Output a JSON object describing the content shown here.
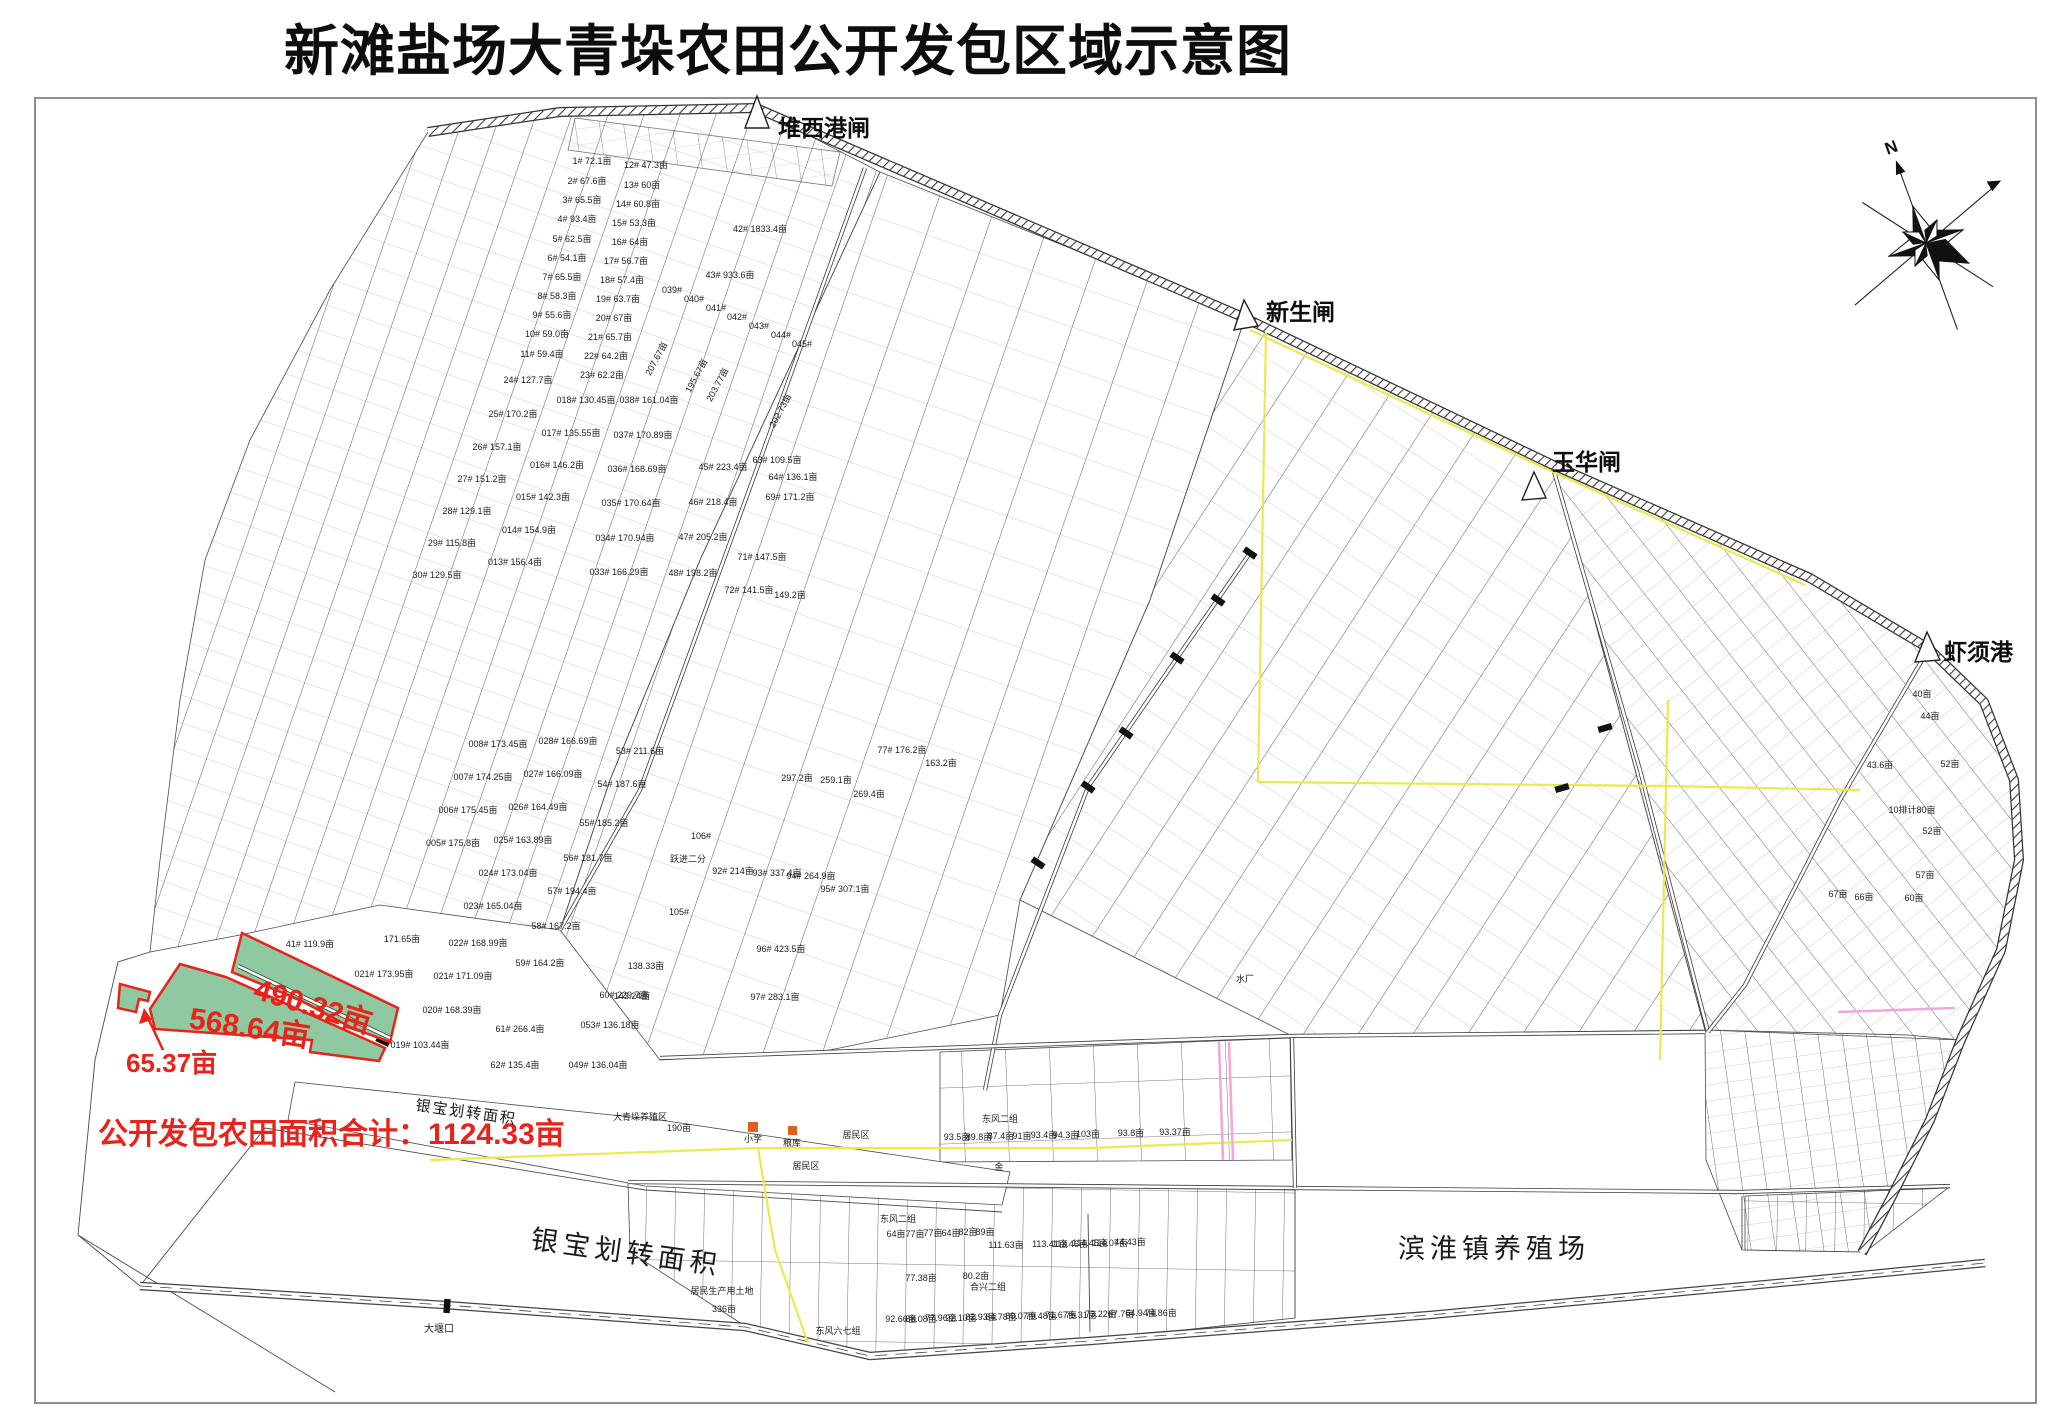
{
  "title": "新滩盐场大青垛农田公开发包区域示意图",
  "colors": {
    "highlight_green": "#8fc9a2",
    "annotation_red": "#e8231a",
    "zone_yellow": "#ece94f",
    "road_pink": "#f0a8da",
    "building_orange": "#e0611f"
  },
  "map": {
    "compass": {
      "label": "N"
    },
    "gates": [
      {
        "label": "堆西港闸"
      },
      {
        "label": "新生闸"
      },
      {
        "label": "玉华闸"
      },
      {
        "label": "虾须港"
      }
    ],
    "highlights": {
      "parcel_490": {
        "label": "490.32亩"
      },
      "parcel_568": {
        "label": "568.64亩"
      },
      "parcel_65": {
        "label": "65.37亩"
      },
      "total": "公开发包农田面积合计：1124.33亩"
    },
    "regions": {
      "yinbao_small": "银宝划转面积",
      "yinbao_large": "银宝划转面积",
      "binhuai": "滨淮镇养殖场",
      "dayankou": "大堰口"
    },
    "parcels": [
      {
        "t": "1# 72.1亩",
        "x": 592,
        "y": 164
      },
      {
        "t": "2# 67.6亩",
        "x": 587,
        "y": 184
      },
      {
        "t": "3# 65.5亩",
        "x": 582,
        "y": 203
      },
      {
        "t": "4# 93.4亩",
        "x": 577,
        "y": 222
      },
      {
        "t": "5# 62.5亩",
        "x": 572,
        "y": 242
      },
      {
        "t": "6# 54.1亩",
        "x": 567,
        "y": 261
      },
      {
        "t": "7# 65.5亩",
        "x": 562,
        "y": 280
      },
      {
        "t": "8# 58.3亩",
        "x": 557,
        "y": 299
      },
      {
        "t": "9# 55.6亩",
        "x": 552,
        "y": 318
      },
      {
        "t": "10# 59.0亩",
        "x": 547,
        "y": 337
      },
      {
        "t": "11# 59.4亩",
        "x": 542,
        "y": 357
      },
      {
        "t": "24# 127.7亩",
        "x": 528,
        "y": 383
      },
      {
        "t": "25# 170.2亩",
        "x": 513,
        "y": 417
      },
      {
        "t": "26# 157.1亩",
        "x": 497,
        "y": 450
      },
      {
        "t": "27# 151.2亩",
        "x": 482,
        "y": 482
      },
      {
        "t": "28# 129.1亩",
        "x": 467,
        "y": 514
      },
      {
        "t": "29# 115.8亩",
        "x": 452,
        "y": 546
      },
      {
        "t": "30# 129.5亩",
        "x": 437,
        "y": 578
      },
      {
        "t": "12# 47.3亩",
        "x": 646,
        "y": 168
      },
      {
        "t": "13# 60亩",
        "x": 642,
        "y": 188
      },
      {
        "t": "14# 60.8亩",
        "x": 638,
        "y": 207
      },
      {
        "t": "15# 53.3亩",
        "x": 634,
        "y": 226
      },
      {
        "t": "16# 64亩",
        "x": 630,
        "y": 245
      },
      {
        "t": "17# 56.7亩",
        "x": 626,
        "y": 264
      },
      {
        "t": "18# 57.4亩",
        "x": 622,
        "y": 283
      },
      {
        "t": "19# 63.7亩",
        "x": 618,
        "y": 302
      },
      {
        "t": "20# 67亩",
        "x": 614,
        "y": 321
      },
      {
        "t": "21# 65.7亩",
        "x": 610,
        "y": 340
      },
      {
        "t": "22# 64.2亩",
        "x": 606,
        "y": 359
      },
      {
        "t": "23# 62.2亩",
        "x": 602,
        "y": 378
      },
      {
        "t": "42#  1833.4亩",
        "x": 760,
        "y": 232,
        "s": 10
      },
      {
        "t": "43#  933.6亩",
        "x": 730,
        "y": 278,
        "s": 10
      },
      {
        "t": "018# 130.45亩",
        "x": 586,
        "y": 403
      },
      {
        "t": "017# 135.55亩",
        "x": 571,
        "y": 436
      },
      {
        "t": "016# 146.2亩",
        "x": 557,
        "y": 468
      },
      {
        "t": "015# 142.3亩",
        "x": 543,
        "y": 500
      },
      {
        "t": "014# 154.9亩",
        "x": 529,
        "y": 533
      },
      {
        "t": "013# 156.4亩",
        "x": 515,
        "y": 565
      },
      {
        "t": "038# 161.04亩",
        "x": 649,
        "y": 403
      },
      {
        "t": "037# 170.89亩",
        "x": 643,
        "y": 438
      },
      {
        "t": "036# 168.69亩",
        "x": 637,
        "y": 472
      },
      {
        "t": "035# 170.64亩",
        "x": 631,
        "y": 506
      },
      {
        "t": "034# 170.94亩",
        "x": 625,
        "y": 541
      },
      {
        "t": "033# 166.29亩",
        "x": 619,
        "y": 575
      },
      {
        "t": "028# 166.69亩",
        "x": 568,
        "y": 744
      },
      {
        "t": "027# 166.09亩",
        "x": 553,
        "y": 777
      },
      {
        "t": "026# 164.49亩",
        "x": 538,
        "y": 810
      },
      {
        "t": "025# 163.89亩",
        "x": 523,
        "y": 843
      },
      {
        "t": "024# 173.04亩",
        "x": 508,
        "y": 876
      },
      {
        "t": "023# 165.04亩",
        "x": 493,
        "y": 909
      },
      {
        "t": "022# 168.99亩",
        "x": 478,
        "y": 946
      },
      {
        "t": "021# 171.09亩",
        "x": 463,
        "y": 979
      },
      {
        "t": "020# 168.39亩",
        "x": 452,
        "y": 1013
      },
      {
        "t": "008# 173.45亩",
        "x": 498,
        "y": 747
      },
      {
        "t": "007# 174.25亩",
        "x": 483,
        "y": 780
      },
      {
        "t": "006# 175.45亩",
        "x": 468,
        "y": 813
      },
      {
        "t": "005# 175.8亩",
        "x": 453,
        "y": 846
      },
      {
        "t": "53# 211.6亩",
        "x": 640,
        "y": 754
      },
      {
        "t": "54# 187.6亩",
        "x": 622,
        "y": 787
      },
      {
        "t": "55# 185.2亩",
        "x": 604,
        "y": 826
      },
      {
        "t": "56# 181.7亩",
        "x": 588,
        "y": 861
      },
      {
        "t": "57# 194.4亩",
        "x": 572,
        "y": 894
      },
      {
        "t": "58# 167.2亩",
        "x": 556,
        "y": 929
      },
      {
        "t": "59# 164.2亩",
        "x": 540,
        "y": 966
      },
      {
        "t": "60# 229.7亩",
        "x": 624,
        "y": 998
      },
      {
        "t": "41# 119.9亩",
        "x": 310,
        "y": 947
      },
      {
        "t": "171.65亩",
        "x": 402,
        "y": 942
      },
      {
        "t": "021# 173.95亩",
        "x": 384,
        "y": 977
      },
      {
        "t": "019# 103.44亩",
        "x": 420,
        "y": 1048
      },
      {
        "t": "61# 266.4亩",
        "x": 520,
        "y": 1032
      },
      {
        "t": "62# 135.4亩",
        "x": 515,
        "y": 1068
      },
      {
        "t": "053# 136.18亩",
        "x": 610,
        "y": 1028
      },
      {
        "t": "049# 136.04亩",
        "x": 598,
        "y": 1068
      },
      {
        "t": "297.2亩",
        "x": 797,
        "y": 781
      },
      {
        "t": "259.1亩",
        "x": 836,
        "y": 783
      },
      {
        "t": "269.4亩",
        "x": 869,
        "y": 797
      },
      {
        "t": "92# 214亩",
        "x": 733,
        "y": 874
      },
      {
        "t": "93# 337.4亩",
        "x": 777,
        "y": 876
      },
      {
        "t": "94# 264.9亩",
        "x": 811,
        "y": 879
      },
      {
        "t": "95# 307.1亩",
        "x": 845,
        "y": 892
      },
      {
        "t": "96# 423.5亩",
        "x": 781,
        "y": 952
      },
      {
        "t": "97# 283.1亩",
        "x": 775,
        "y": 1000
      },
      {
        "t": "77# 176.2亩",
        "x": 902,
        "y": 753
      },
      {
        "t": "163.2亩",
        "x": 941,
        "y": 766
      },
      {
        "t": "106#",
        "x": 701,
        "y": 839
      },
      {
        "t": "跃进二分",
        "x": 688,
        "y": 862,
        "s": 8
      },
      {
        "t": "105#",
        "x": 679,
        "y": 915
      },
      {
        "t": "143.24亩",
        "x": 632,
        "y": 999
      },
      {
        "t": "138.33亩",
        "x": 646,
        "y": 969
      },
      {
        "t": "039#",
        "x": 672,
        "y": 293
      },
      {
        "t": "040#",
        "x": 694,
        "y": 302
      },
      {
        "t": "041#",
        "x": 716,
        "y": 311
      },
      {
        "t": "042#",
        "x": 737,
        "y": 320
      },
      {
        "t": "043#",
        "x": 759,
        "y": 329
      },
      {
        "t": "044#",
        "x": 781,
        "y": 338
      },
      {
        "t": "045#",
        "x": 802,
        "y": 347
      },
      {
        "t": "207.67亩",
        "x": 659,
        "y": 360,
        "r": -62
      },
      {
        "t": "195.67亩",
        "x": 699,
        "y": 377,
        "r": -62
      },
      {
        "t": "203.77亩",
        "x": 720,
        "y": 386,
        "r": -62
      },
      {
        "t": "202.73亩",
        "x": 783,
        "y": 412,
        "r": -62
      },
      {
        "t": "45# 223.4亩",
        "x": 723,
        "y": 470
      },
      {
        "t": "46# 218.4亩",
        "x": 713,
        "y": 505
      },
      {
        "t": "47# 205.2亩",
        "x": 703,
        "y": 540
      },
      {
        "t": "48# 198.2亩",
        "x": 693,
        "y": 576
      },
      {
        "t": "63# 109.5亩",
        "x": 777,
        "y": 463
      },
      {
        "t": "64# 136.1亩",
        "x": 793,
        "y": 480
      },
      {
        "t": "69# 171.2亩",
        "x": 790,
        "y": 500
      },
      {
        "t": "71# 147.5亩",
        "x": 762,
        "y": 560
      },
      {
        "t": "72# 141.5亩",
        "x": 749,
        "y": 593
      },
      {
        "t": "149.2亩",
        "x": 790,
        "y": 598
      },
      {
        "t": "东风二组",
        "x": 898,
        "y": 1222,
        "s": 8
      },
      {
        "t": "64亩",
        "x": 896,
        "y": 1237,
        "s": 8
      },
      {
        "t": "77亩",
        "x": 915,
        "y": 1237,
        "s": 8
      },
      {
        "t": "77亩",
        "x": 933,
        "y": 1236,
        "s": 8
      },
      {
        "t": "64亩",
        "x": 951,
        "y": 1236,
        "s": 8
      },
      {
        "t": "82亩",
        "x": 968,
        "y": 1235,
        "s": 8
      },
      {
        "t": "89亩",
        "x": 985,
        "y": 1235,
        "s": 8
      },
      {
        "t": "77.38亩",
        "x": 921,
        "y": 1281,
        "s": 8
      },
      {
        "t": "80.2亩",
        "x": 976,
        "y": 1279,
        "s": 8
      },
      {
        "t": "111.63亩",
        "x": 1006,
        "y": 1248,
        "s": 8
      },
      {
        "t": "113.41亩",
        "x": 1050,
        "y": 1247,
        "s": 8
      },
      {
        "t": "113.46亩",
        "x": 1070,
        "y": 1247,
        "s": 8
      },
      {
        "t": "114.45亩",
        "x": 1090,
        "y": 1246,
        "s": 8
      },
      {
        "t": "114.07亩",
        "x": 1110,
        "y": 1246,
        "s": 8
      },
      {
        "t": "44.43亩",
        "x": 1130,
        "y": 1245,
        "s": 8
      },
      {
        "t": "92.66亩",
        "x": 901,
        "y": 1322,
        "s": 8
      },
      {
        "t": "88.08亩",
        "x": 921,
        "y": 1322,
        "s": 8
      },
      {
        "t": "77.96亩",
        "x": 941,
        "y": 1321,
        "s": 8
      },
      {
        "t": "92.10亩",
        "x": 961,
        "y": 1321,
        "s": 8
      },
      {
        "t": "82.93亩",
        "x": 981,
        "y": 1320,
        "s": 8
      },
      {
        "t": "84.78亩",
        "x": 1001,
        "y": 1320,
        "s": 8
      },
      {
        "t": "80.07亩",
        "x": 1021,
        "y": 1319,
        "s": 8
      },
      {
        "t": "79.48亩",
        "x": 1041,
        "y": 1319,
        "s": 8
      },
      {
        "t": "71.67亩",
        "x": 1061,
        "y": 1318,
        "s": 8
      },
      {
        "t": "75.31亩",
        "x": 1081,
        "y": 1318,
        "s": 8
      },
      {
        "t": "73.22亩",
        "x": 1101,
        "y": 1317,
        "s": 8
      },
      {
        "t": "67.7亩",
        "x": 1121,
        "y": 1317,
        "s": 8
      },
      {
        "t": "64.94亩",
        "x": 1141,
        "y": 1316,
        "s": 8
      },
      {
        "t": "74.86亩",
        "x": 1161,
        "y": 1316,
        "s": 8
      },
      {
        "t": "东风二组",
        "x": 1000,
        "y": 1122,
        "s": 8
      },
      {
        "t": "93.5亩",
        "x": 957,
        "y": 1140,
        "s": 8
      },
      {
        "t": "89.8亩",
        "x": 979,
        "y": 1140,
        "s": 8
      },
      {
        "t": "87.4亩",
        "x": 1001,
        "y": 1139,
        "s": 8
      },
      {
        "t": "91亩",
        "x": 1022,
        "y": 1139,
        "s": 8
      },
      {
        "t": "93.4亩",
        "x": 1044,
        "y": 1138,
        "s": 8
      },
      {
        "t": "94.3亩",
        "x": 1066,
        "y": 1138,
        "s": 8
      },
      {
        "t": "103亩",
        "x": 1088,
        "y": 1137,
        "s": 8
      },
      {
        "t": "93.8亩",
        "x": 1131,
        "y": 1136,
        "s": 8
      },
      {
        "t": "93.37亩",
        "x": 1175,
        "y": 1135,
        "s": 8
      },
      {
        "t": "小学",
        "x": 753,
        "y": 1142,
        "s": 8
      },
      {
        "t": "粮库",
        "x": 792,
        "y": 1146,
        "s": 8
      },
      {
        "t": "居民区",
        "x": 806,
        "y": 1169,
        "s": 8
      },
      {
        "t": "居民区",
        "x": 856,
        "y": 1138,
        "s": 8
      },
      {
        "t": "金",
        "x": 999,
        "y": 1170,
        "s": 8
      },
      {
        "t": "居民生产用土地",
        "x": 722,
        "y": 1294,
        "s": 8
      },
      {
        "t": "336亩",
        "x": 724,
        "y": 1312,
        "s": 8
      },
      {
        "t": "东风六七组",
        "x": 838,
        "y": 1334,
        "s": 8
      },
      {
        "t": "合兴二组",
        "x": 988,
        "y": 1290,
        "s": 8
      },
      {
        "t": "大青垛养殖区",
        "x": 640,
        "y": 1120,
        "s": 8
      },
      {
        "t": "190亩",
        "x": 679,
        "y": 1131,
        "s": 8
      },
      {
        "t": "水厂",
        "x": 1245,
        "y": 982,
        "s": 8
      },
      {
        "t": "40亩",
        "x": 1922,
        "y": 697,
        "s": 8
      },
      {
        "t": "44亩",
        "x": 1930,
        "y": 719,
        "s": 8
      },
      {
        "t": "52亩",
        "x": 1950,
        "y": 767,
        "s": 8
      },
      {
        "t": "43.6亩",
        "x": 1880,
        "y": 768,
        "s": 8
      },
      {
        "t": "10排计80亩",
        "x": 1912,
        "y": 813,
        "s": 8
      },
      {
        "t": "52亩",
        "x": 1932,
        "y": 834,
        "s": 8
      },
      {
        "t": "57亩",
        "x": 1925,
        "y": 878,
        "s": 8
      },
      {
        "t": "67亩",
        "x": 1838,
        "y": 897,
        "s": 8
      },
      {
        "t": "66亩",
        "x": 1864,
        "y": 900,
        "s": 8
      },
      {
        "t": "60亩",
        "x": 1914,
        "y": 901,
        "s": 8
      }
    ]
  }
}
